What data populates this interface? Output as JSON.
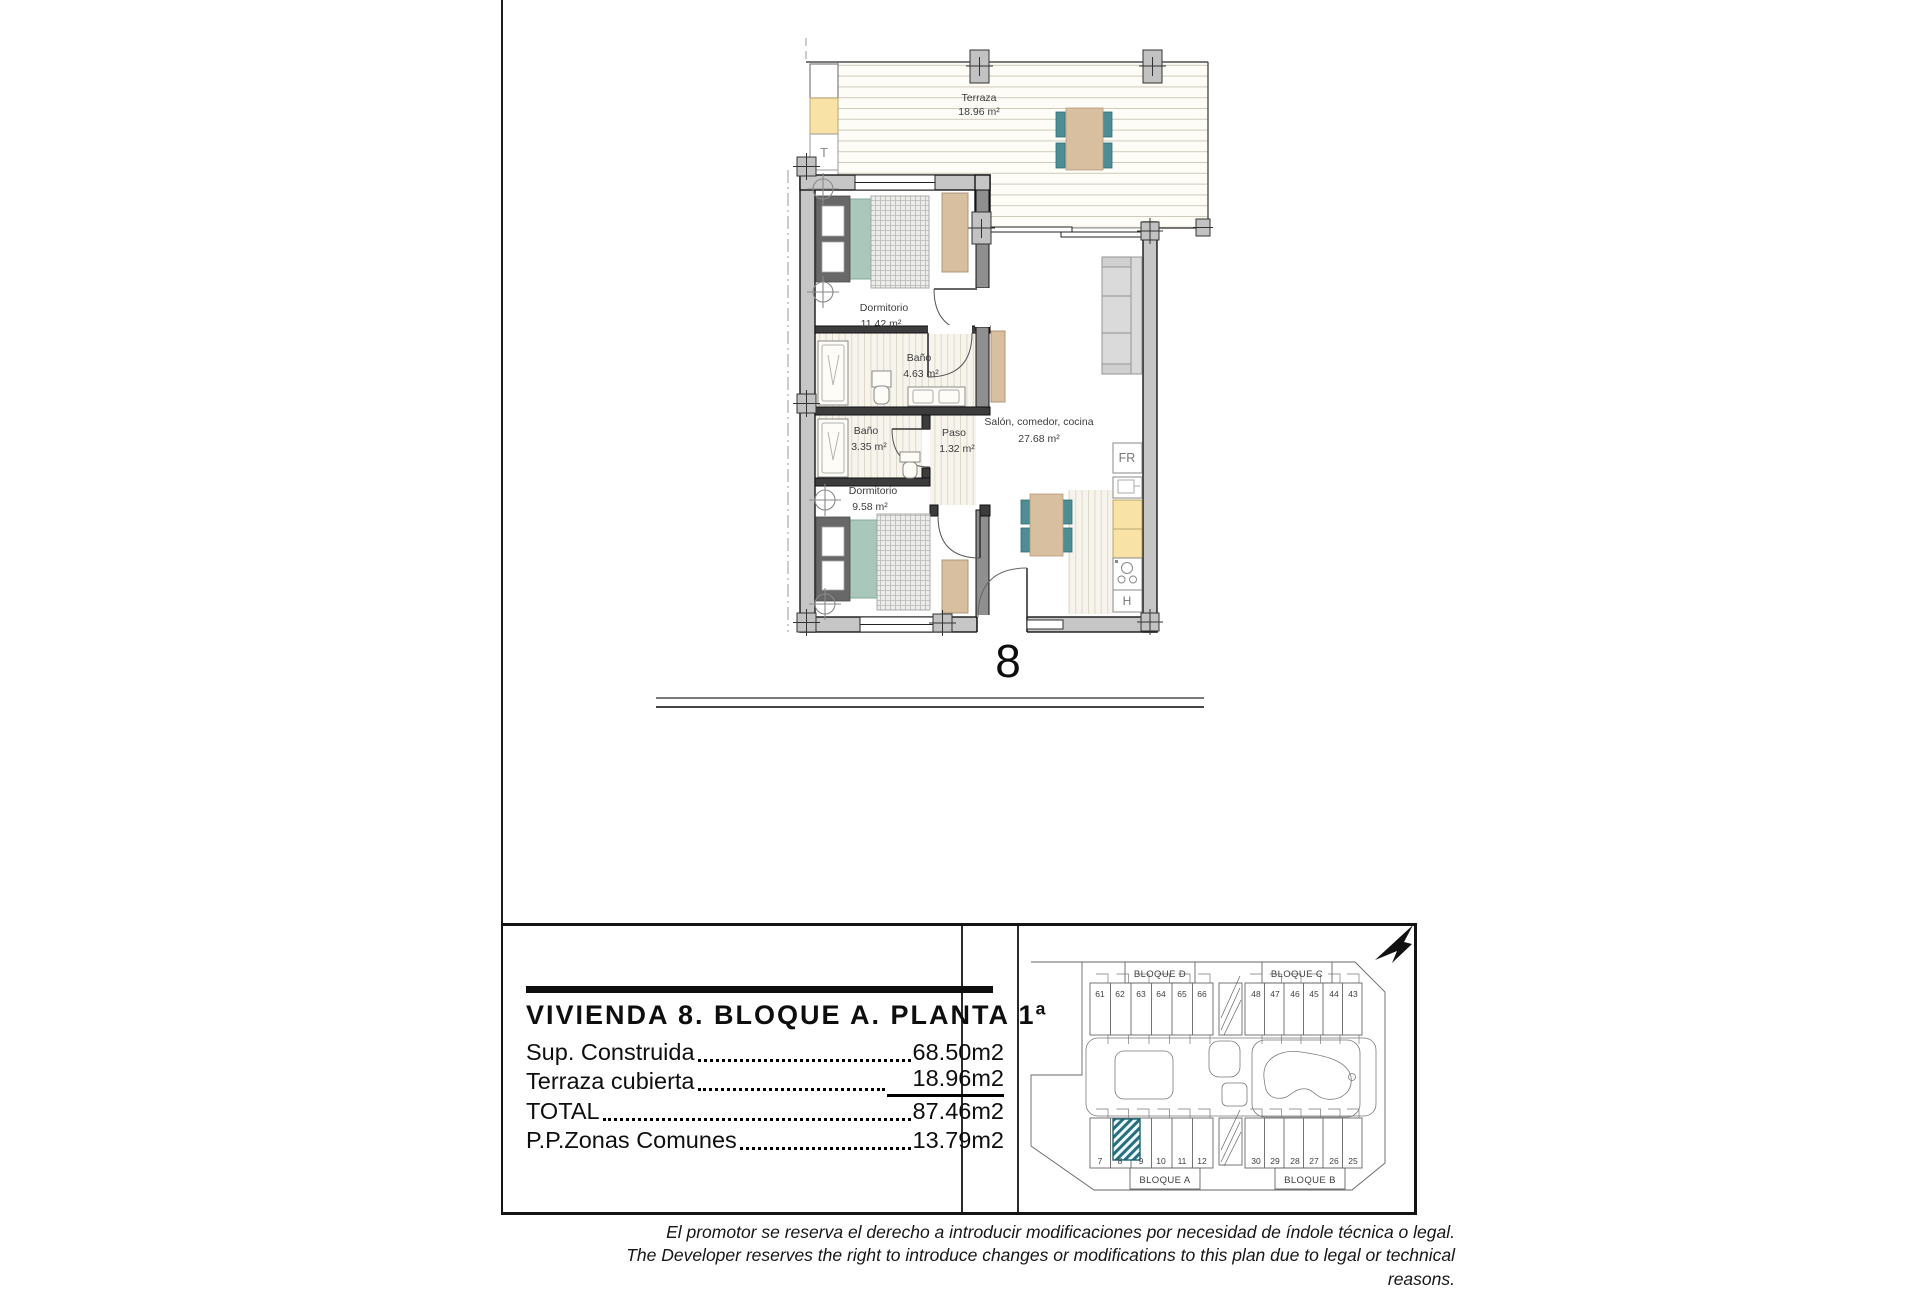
{
  "floor_plan": {
    "unit_number": "8",
    "rooms": {
      "terraza": {
        "name": "Terraza",
        "area": "18.96 m²"
      },
      "dormitorio1": {
        "name": "Dormitorio",
        "area": "11.42 m²"
      },
      "bano1": {
        "name": "Baño",
        "area": "4.63 m²"
      },
      "bano2": {
        "name": "Baño",
        "area": "3.35 m²"
      },
      "paso": {
        "name": "Paso",
        "area": "1.32 m²"
      },
      "dormitorio2": {
        "name": "Dormitorio",
        "area": "9.58 m²"
      },
      "salon": {
        "name": "Salón, comedor, cocina",
        "area": "27.68 m²"
      }
    },
    "labels": {
      "storage": "T",
      "fridge": "FR",
      "oven": "H"
    }
  },
  "info_panel": {
    "title": "VIVIENDA 8. BLOQUE A. PLANTA 1ª",
    "rows": [
      {
        "label": "Sup. Construida",
        "value": "68.50m2"
      },
      {
        "label": "Terraza cubierta",
        "value": "18.96m2"
      },
      {
        "label": "TOTAL",
        "value": "87.46m2"
      },
      {
        "label": "P.P.Zonas Comunes",
        "value": "13.79m2"
      }
    ]
  },
  "site_plan": {
    "blocks": {
      "d": {
        "name": "BLOQUE D",
        "units": [
          "61",
          "62",
          "63",
          "64",
          "65",
          "66"
        ]
      },
      "c": {
        "name": "BLOQUE C",
        "units": [
          "48",
          "47",
          "46",
          "45",
          "44",
          "43"
        ]
      },
      "a": {
        "name": "BLOQUE A",
        "units": [
          "7",
          "8",
          "9",
          "10",
          "11",
          "12"
        ]
      },
      "b": {
        "name": "BLOQUE B",
        "units": [
          "30",
          "29",
          "28",
          "27",
          "26",
          "25"
        ]
      }
    },
    "highlighted_unit": "8",
    "highlight_color": "#26707f"
  },
  "disclaimer": {
    "es": "El promotor se reserva el derecho a introducir modificaciones por necesidad de índole técnica o legal.",
    "en": "The Developer reserves the right to introduce changes or modifications to this plan due to legal or technical reasons."
  },
  "colors": {
    "wall": "#c6c6c6",
    "bed": "#a9c7bb",
    "chair": "#4d8d93",
    "wood": "#d8bf9f",
    "counter": "#f8e2a6",
    "accent": "#26707f"
  }
}
